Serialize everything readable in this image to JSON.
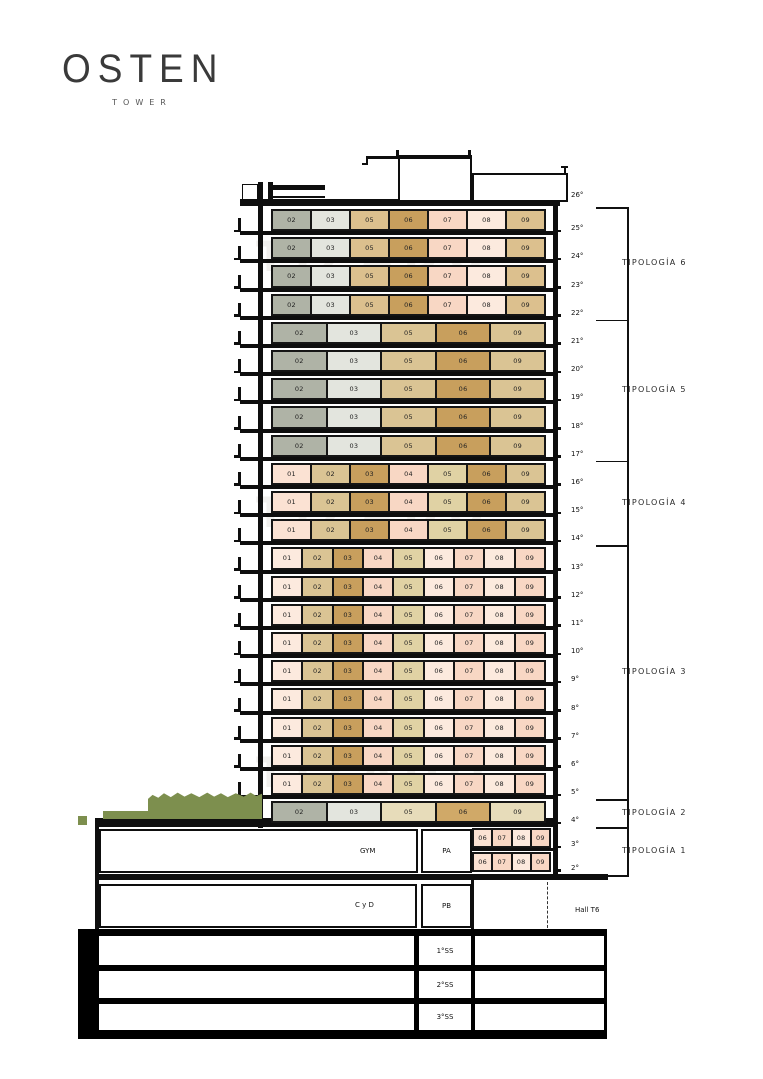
{
  "logo": {
    "title": "OSTEN",
    "subtitle": "TOWER"
  },
  "watermark": "TIZADO",
  "palette": {
    "sage": "#afb3a6",
    "mist": "#e3e5de",
    "tan": "#dcc08e",
    "ochre": "#c89f5d",
    "peach": "#f8d7c4",
    "blush": "#fceade",
    "camel": "#dac494",
    "sand": "#e0d2a4",
    "blushlight": "#fbe2d3",
    "palesand": "#e7dcba",
    "caramel": "#d0a968"
  },
  "typologies": [
    {
      "id": "6",
      "name": "TIPOLOGÍA 6",
      "floor_range": [
        "22°",
        "25°"
      ],
      "units": [
        {
          "unit": "02",
          "color": "sage"
        },
        {
          "unit": "03",
          "color": "mist"
        },
        {
          "unit": "05",
          "color": "tan"
        },
        {
          "unit": "06",
          "color": "ochre"
        },
        {
          "unit": "07",
          "color": "peach"
        },
        {
          "unit": "08",
          "color": "blush"
        },
        {
          "unit": "09",
          "color": "tan"
        }
      ]
    },
    {
      "id": "5",
      "name": "TIPOLOGÍA 5",
      "floor_range": [
        "17°",
        "21°"
      ],
      "units": [
        {
          "unit": "02",
          "color": "sage"
        },
        {
          "unit": "03",
          "color": "mist"
        },
        {
          "unit": "05",
          "color": "camel"
        },
        {
          "unit": "06",
          "color": "ochre"
        },
        {
          "unit": "09",
          "color": "camel"
        }
      ]
    },
    {
      "id": "4",
      "name": "TIPOLOGÍA 4",
      "floor_range": [
        "14°",
        "16°"
      ],
      "units": [
        {
          "unit": "01",
          "color": "blushlight"
        },
        {
          "unit": "02",
          "color": "camel"
        },
        {
          "unit": "03",
          "color": "ochre"
        },
        {
          "unit": "04",
          "color": "peach"
        },
        {
          "unit": "05",
          "color": "sand"
        },
        {
          "unit": "06",
          "color": "ochre"
        },
        {
          "unit": "09",
          "color": "camel"
        }
      ]
    },
    {
      "id": "3",
      "name": "TIPOLOGÍA 3",
      "floor_range": [
        "5°",
        "13°"
      ],
      "units": [
        {
          "unit": "01",
          "color": "blush"
        },
        {
          "unit": "02",
          "color": "camel"
        },
        {
          "unit": "03",
          "color": "ochre"
        },
        {
          "unit": "04",
          "color": "peach"
        },
        {
          "unit": "05",
          "color": "sand"
        },
        {
          "unit": "06",
          "color": "blush"
        },
        {
          "unit": "07",
          "color": "peach"
        },
        {
          "unit": "08",
          "color": "blush"
        },
        {
          "unit": "09",
          "color": "peach"
        }
      ]
    },
    {
      "id": "2",
      "name": "TIPOLOGÍA 2",
      "floor_range": [
        "4°",
        "4°"
      ],
      "units": [
        {
          "unit": "02",
          "color": "sage"
        },
        {
          "unit": "03",
          "color": "mist"
        },
        {
          "unit": "05",
          "color": "palesand"
        },
        {
          "unit": "06",
          "color": "caramel"
        },
        {
          "unit": "09",
          "color": "palesand"
        }
      ]
    },
    {
      "id": "1",
      "name": "TIPOLOGÍA 1",
      "floor_range": [
        "2°",
        "3°"
      ],
      "right_only": true,
      "units": [
        {
          "unit": "06",
          "color": "blushlight"
        },
        {
          "unit": "07",
          "color": "peach"
        },
        {
          "unit": "08",
          "color": "blush"
        },
        {
          "unit": "09",
          "color": "peach"
        }
      ]
    }
  ],
  "tower": {
    "roof_label": "26°",
    "floors": [
      {
        "label": "25°",
        "typology": "6"
      },
      {
        "label": "24°",
        "typology": "6"
      },
      {
        "label": "23°",
        "typology": "6"
      },
      {
        "label": "22°",
        "typology": "6"
      },
      {
        "label": "21°",
        "typology": "5"
      },
      {
        "label": "20°",
        "typology": "5"
      },
      {
        "label": "19°",
        "typology": "5"
      },
      {
        "label": "18°",
        "typology": "5"
      },
      {
        "label": "17°",
        "typology": "5"
      },
      {
        "label": "16°",
        "typology": "4"
      },
      {
        "label": "15°",
        "typology": "4"
      },
      {
        "label": "14°",
        "typology": "4"
      },
      {
        "label": "13°",
        "typology": "3"
      },
      {
        "label": "12°",
        "typology": "3"
      },
      {
        "label": "11°",
        "typology": "3"
      },
      {
        "label": "10°",
        "typology": "3"
      },
      {
        "label": "9°",
        "typology": "3"
      },
      {
        "label": "8°",
        "typology": "3"
      },
      {
        "label": "7°",
        "typology": "3"
      },
      {
        "label": "6°",
        "typology": "3"
      },
      {
        "label": "5°",
        "typology": "3"
      },
      {
        "label": "4°",
        "typology": "2"
      },
      {
        "label": "3°",
        "typology": "1"
      },
      {
        "label": "2°",
        "typology": "1"
      }
    ]
  },
  "podium": {
    "gym_label": "GYM",
    "pa_label": "PA",
    "cyd_label": "C y D",
    "pb_label": "PB",
    "hall_label": "Hall T6",
    "basement_labels": [
      "1°SS",
      "2°SS",
      "3°SS"
    ]
  }
}
